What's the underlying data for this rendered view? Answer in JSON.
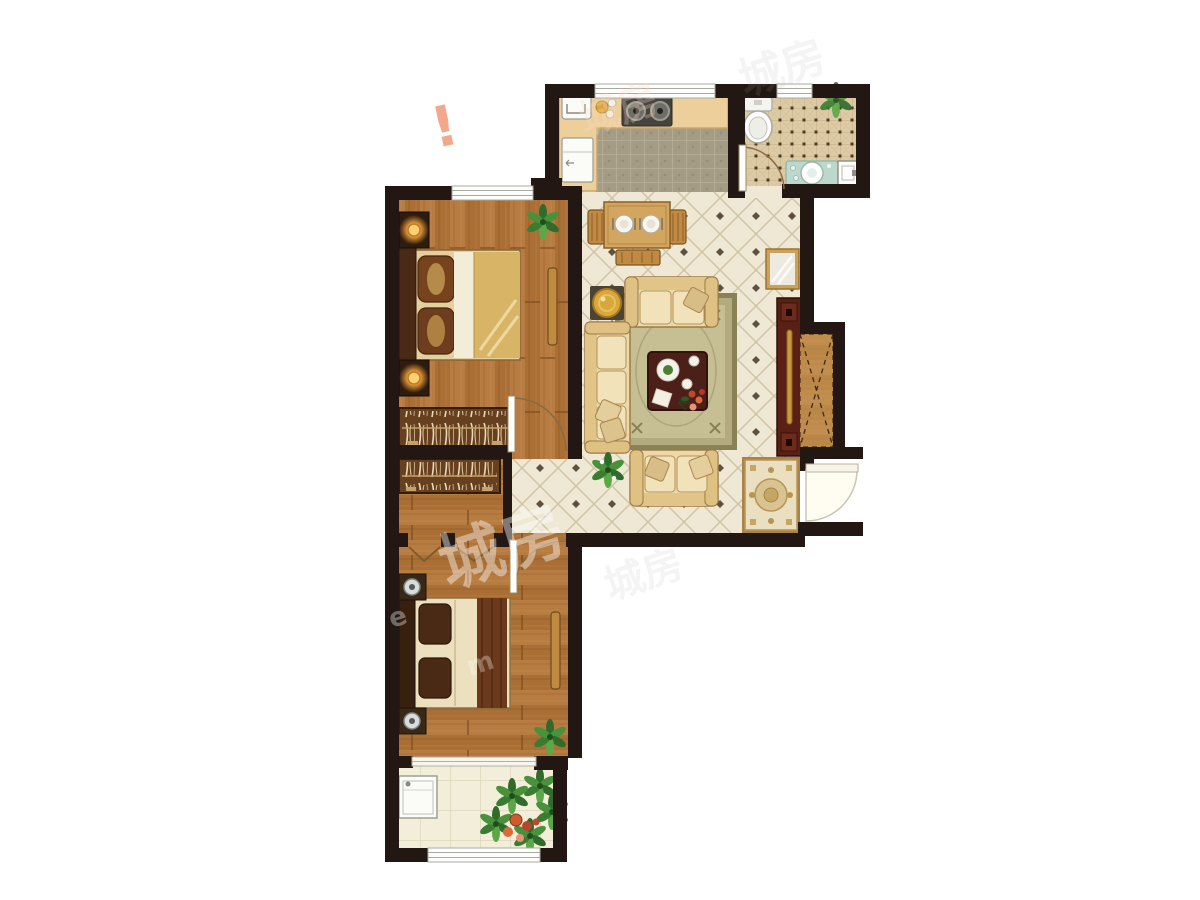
{
  "document": {
    "type": "apartment floor plan rendering",
    "background": "#ffffff",
    "plan_orientation": "top-down"
  },
  "palette": {
    "wall": "#221712",
    "wood_floor": "#b5793e",
    "wood_floor_dark": "#a96f34",
    "living_tile": "#efe8d4",
    "living_tile_line": "#cfc3a6",
    "living_tile_dot": "#5f5140",
    "kitchen_mosaic": "#a49c84",
    "bath_tile": "#dccaa4",
    "balcony_tile": "#f3eed9",
    "counter": "#eccf9b",
    "sofa_cream": "#ecd8a8",
    "rug_sage": "#b6b089",
    "coffee_table": "#4c2018",
    "tv_cabinet": "#5a2015",
    "bed_quilt_gold": "#d8b566",
    "wardrobe": "#66401f",
    "entry_rug": "#eadfc0",
    "plant_green": "#3f8a35",
    "lamp_glow": "#ffc15e",
    "door_arc": "#8a6a42"
  },
  "watermarks": [
    {
      "text": "城房",
      "color": "#ffffff",
      "opacity": 0.42,
      "size": 64,
      "x": 448,
      "y": 588,
      "rotate": -18
    },
    {
      "text": "e",
      "color": "#ffffff",
      "opacity": 0.35,
      "size": 26,
      "x": 392,
      "y": 628,
      "rotate": -18
    },
    {
      "text": "m",
      "color": "#ffffff",
      "opacity": 0.3,
      "size": 26,
      "x": 470,
      "y": 676,
      "rotate": -18
    },
    {
      "text": "!",
      "color": "#e8622d",
      "opacity": 0.55,
      "size": 56,
      "x": 436,
      "y": 148,
      "rotate": -12
    },
    {
      "text": "城房",
      "color": "#fddbc8",
      "opacity": 0.28,
      "size": 40,
      "x": 585,
      "y": 135,
      "rotate": -18
    },
    {
      "text": "城房",
      "color": "#aaaaaa",
      "opacity": 0.12,
      "size": 44,
      "x": 745,
      "y": 96,
      "rotate": -18
    },
    {
      "text": "城房",
      "color": "#999999",
      "opacity": 0.1,
      "size": 40,
      "x": 610,
      "y": 600,
      "rotate": -18
    }
  ],
  "rooms": [
    {
      "name": "kitchen",
      "floor": "mosaic tile",
      "furniture": [
        "l-shaped-counter",
        "sink",
        "two-burner-stove",
        "bowls",
        "fridge"
      ],
      "openings": [
        "window-top",
        "open-to-dining"
      ]
    },
    {
      "name": "bathroom",
      "floor": "lattice tile",
      "furniture": [
        "toilet",
        "vanity-with-round-basin",
        "washbasin-unit",
        "plant"
      ],
      "openings": [
        "window-top",
        "swing-door-bottom"
      ]
    },
    {
      "name": "living-dining-room",
      "floor": "diamond tile",
      "furniture": [
        "dining-table-for-two",
        "two-dining-chairs",
        "dining-bench",
        "round-gold-side-table",
        "three-seat-sofa",
        "two-seat-sofa-top",
        "two-seat-sofa-bottom",
        "area-rug",
        "coffee-table-with-tea-set",
        "floor-plant",
        "tv-cabinet",
        "wall-mirror",
        "hatched-entry-cabinet",
        "ornate-entry-rug"
      ],
      "openings": [
        "entry-door-right"
      ]
    },
    {
      "name": "bedroom-1",
      "floor": "wood planks vertical",
      "furniture": [
        "double-bed-gold-quilt",
        "two-nightstands-with-lamps",
        "wardrobe-with-clothes",
        "slim-bench",
        "plant"
      ],
      "openings": [
        "window-top",
        "swing-door-bottom-right"
      ]
    },
    {
      "name": "walk-in-closet",
      "floor": "wood planks",
      "furniture": [
        "wardrobe-with-clothes"
      ],
      "openings": [
        "two-hinged-closet-doors"
      ]
    },
    {
      "name": "bedroom-2",
      "floor": "wood planks horizontal",
      "furniture": [
        "double-bed-brown-runner",
        "two-nightstands-with-lamps",
        "slim-bench",
        "plant"
      ],
      "openings": [
        "swing-door-top",
        "sliding-door-to-balcony"
      ]
    },
    {
      "name": "balcony",
      "floor": "pale tile",
      "furniture": [
        "washing-machine",
        "potted-plants"
      ],
      "openings": [
        "window-bottom"
      ]
    }
  ]
}
